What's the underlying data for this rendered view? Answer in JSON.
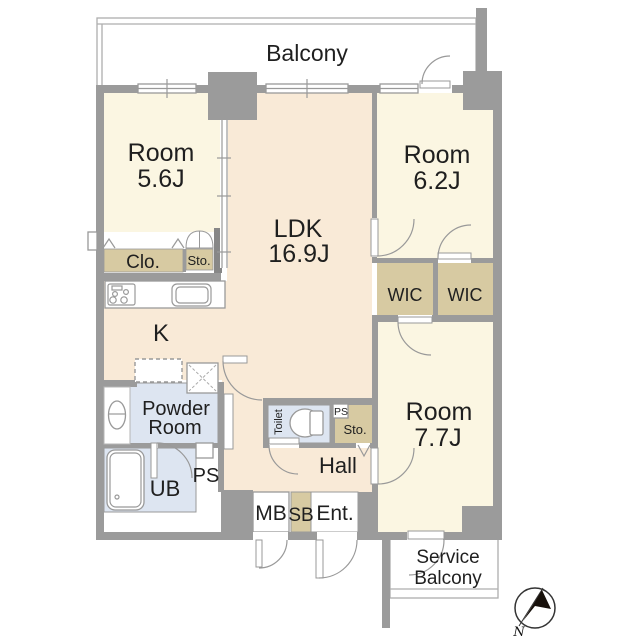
{
  "colors": {
    "wall": "#9b9b9b",
    "wall_dark": "#878787",
    "cream": "#fbf6e2",
    "peach": "#f9ead7",
    "tan": "#d7caa2",
    "blue": "#dde5f1",
    "line": "#999999",
    "balcony_line": "#aeaeae",
    "text": "#1f1f1f",
    "compass_ink": "#17100a"
  },
  "labels": {
    "balcony": "Balcony",
    "room1_name": "Room",
    "room1_size": "5.6J",
    "ldk_name": "LDK",
    "ldk_size": "16.9J",
    "room2_name": "Room",
    "room2_size": "6.2J",
    "room3_name": "Room",
    "room3_size": "7.7J",
    "clo": "Clo.",
    "sto_upper": "Sto.",
    "wic_left": "WIC",
    "wic_right": "WIC",
    "kitchen": "K",
    "powder_line1": "Powder",
    "powder_line2": "Room",
    "toilet": "Toilet",
    "ps_small": "PS",
    "sto_lower": "Sto.",
    "hall": "Hall",
    "ub": "UB",
    "ps_large": "PS",
    "mb": "MB",
    "sb": "SB",
    "ent": "Ent.",
    "service_line1": "Service",
    "service_line2": "Balcony",
    "compass_north": "N"
  }
}
